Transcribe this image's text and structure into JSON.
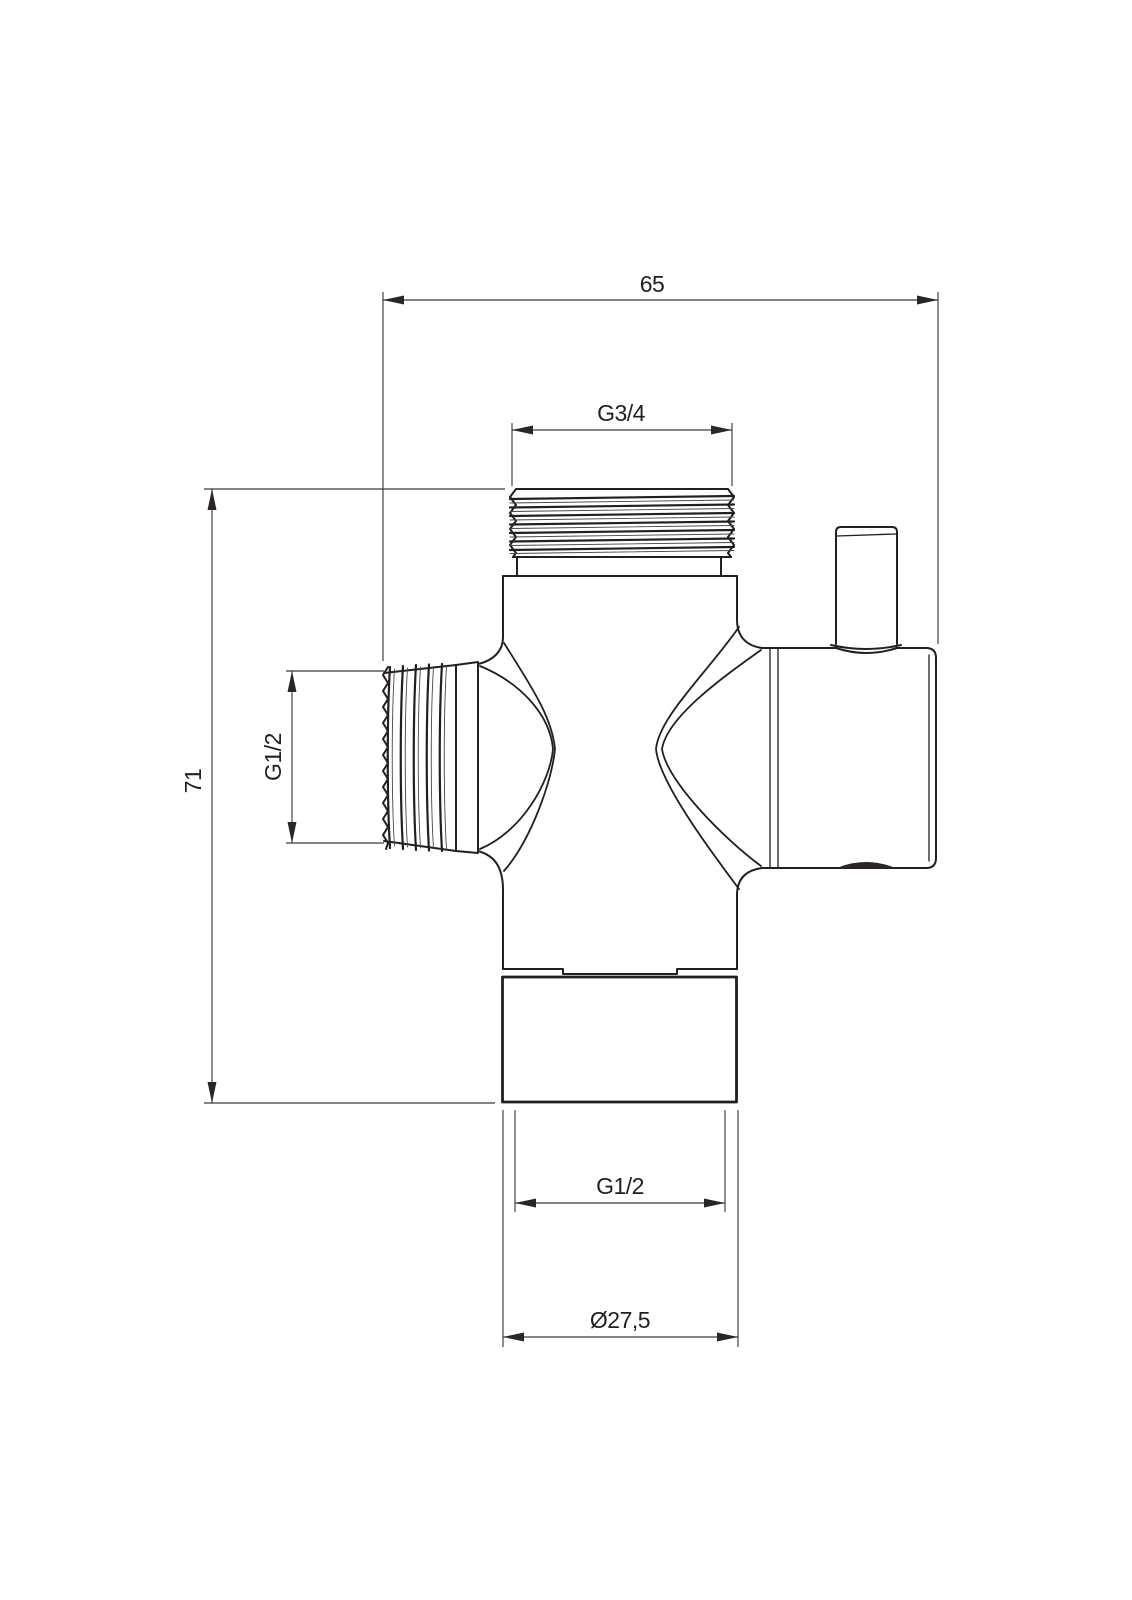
{
  "page": {
    "background": "#ffffff"
  },
  "drawing": {
    "kind": "technical dimension drawing of a shower diverter valve",
    "stroke_color": "#231f20",
    "dimension_color": "#3d393b",
    "labels": {
      "overall_width": "65",
      "top_thread": "G3/4",
      "side_thread": "G1/2",
      "overall_height": "71",
      "bottom_thread": "G1/2",
      "bottom_diameter": "Ø27,5"
    }
  }
}
